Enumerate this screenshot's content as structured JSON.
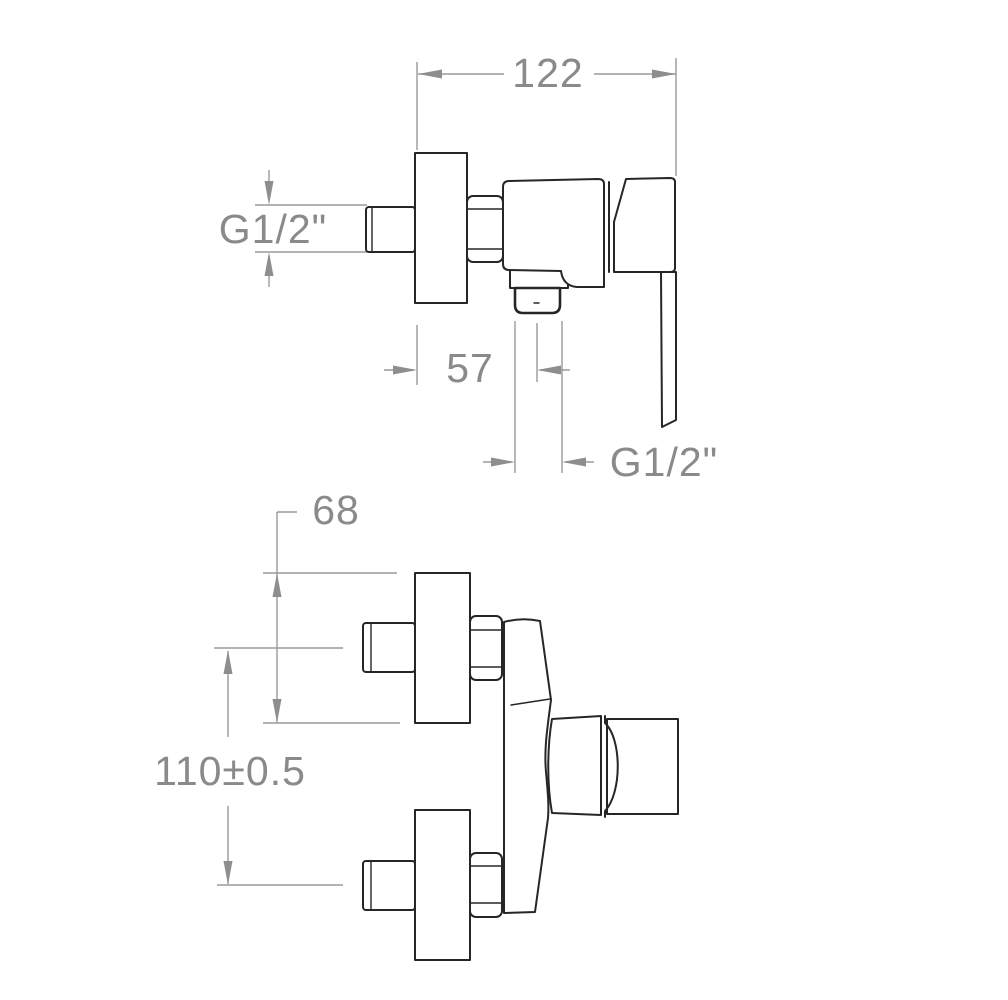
{
  "drawing": {
    "type": "technical dimension drawing, two orthographic views",
    "subject": "wall-mounted single-lever shower mixer valve",
    "colors": {
      "background": "#ffffff",
      "line": "#262626",
      "dimension": "#8a8a8a"
    },
    "side_view": {
      "dimensions": {
        "overall_depth": "122",
        "inlet_thread": "G1/2\"",
        "outlet_offset": "57",
        "outlet_thread": "G1/2\""
      }
    },
    "front_view": {
      "dimensions": {
        "escutcheon_height": "68",
        "inlet_spacing": "110±0.5"
      }
    }
  }
}
